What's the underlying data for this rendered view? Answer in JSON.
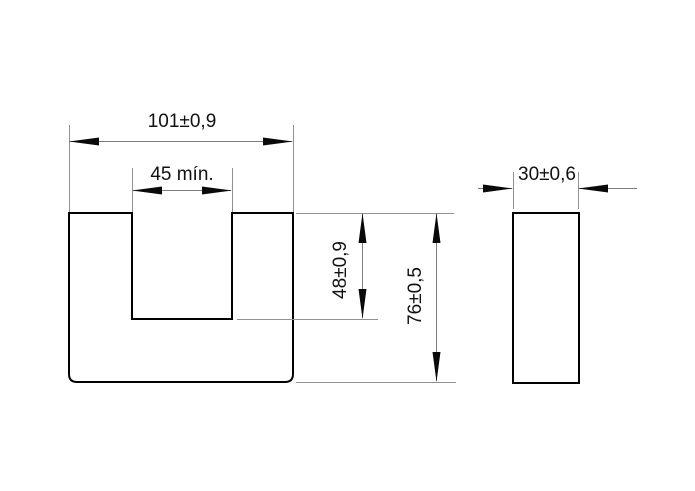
{
  "drawing": {
    "type": "technical-dimension-drawing",
    "part": "U-shaped core, front view and side view",
    "colors": {
      "background": "#ffffff",
      "outline": "#000000",
      "dimension_line": "#7d7d7d",
      "extension_line": "#919191",
      "text": "#111111"
    },
    "dimensions": {
      "outer_width": "101±0,9",
      "slot_width": "45 mín.",
      "slot_depth": "48±0,9",
      "total_height": "76±0,5",
      "thickness": "30±0,6"
    }
  }
}
